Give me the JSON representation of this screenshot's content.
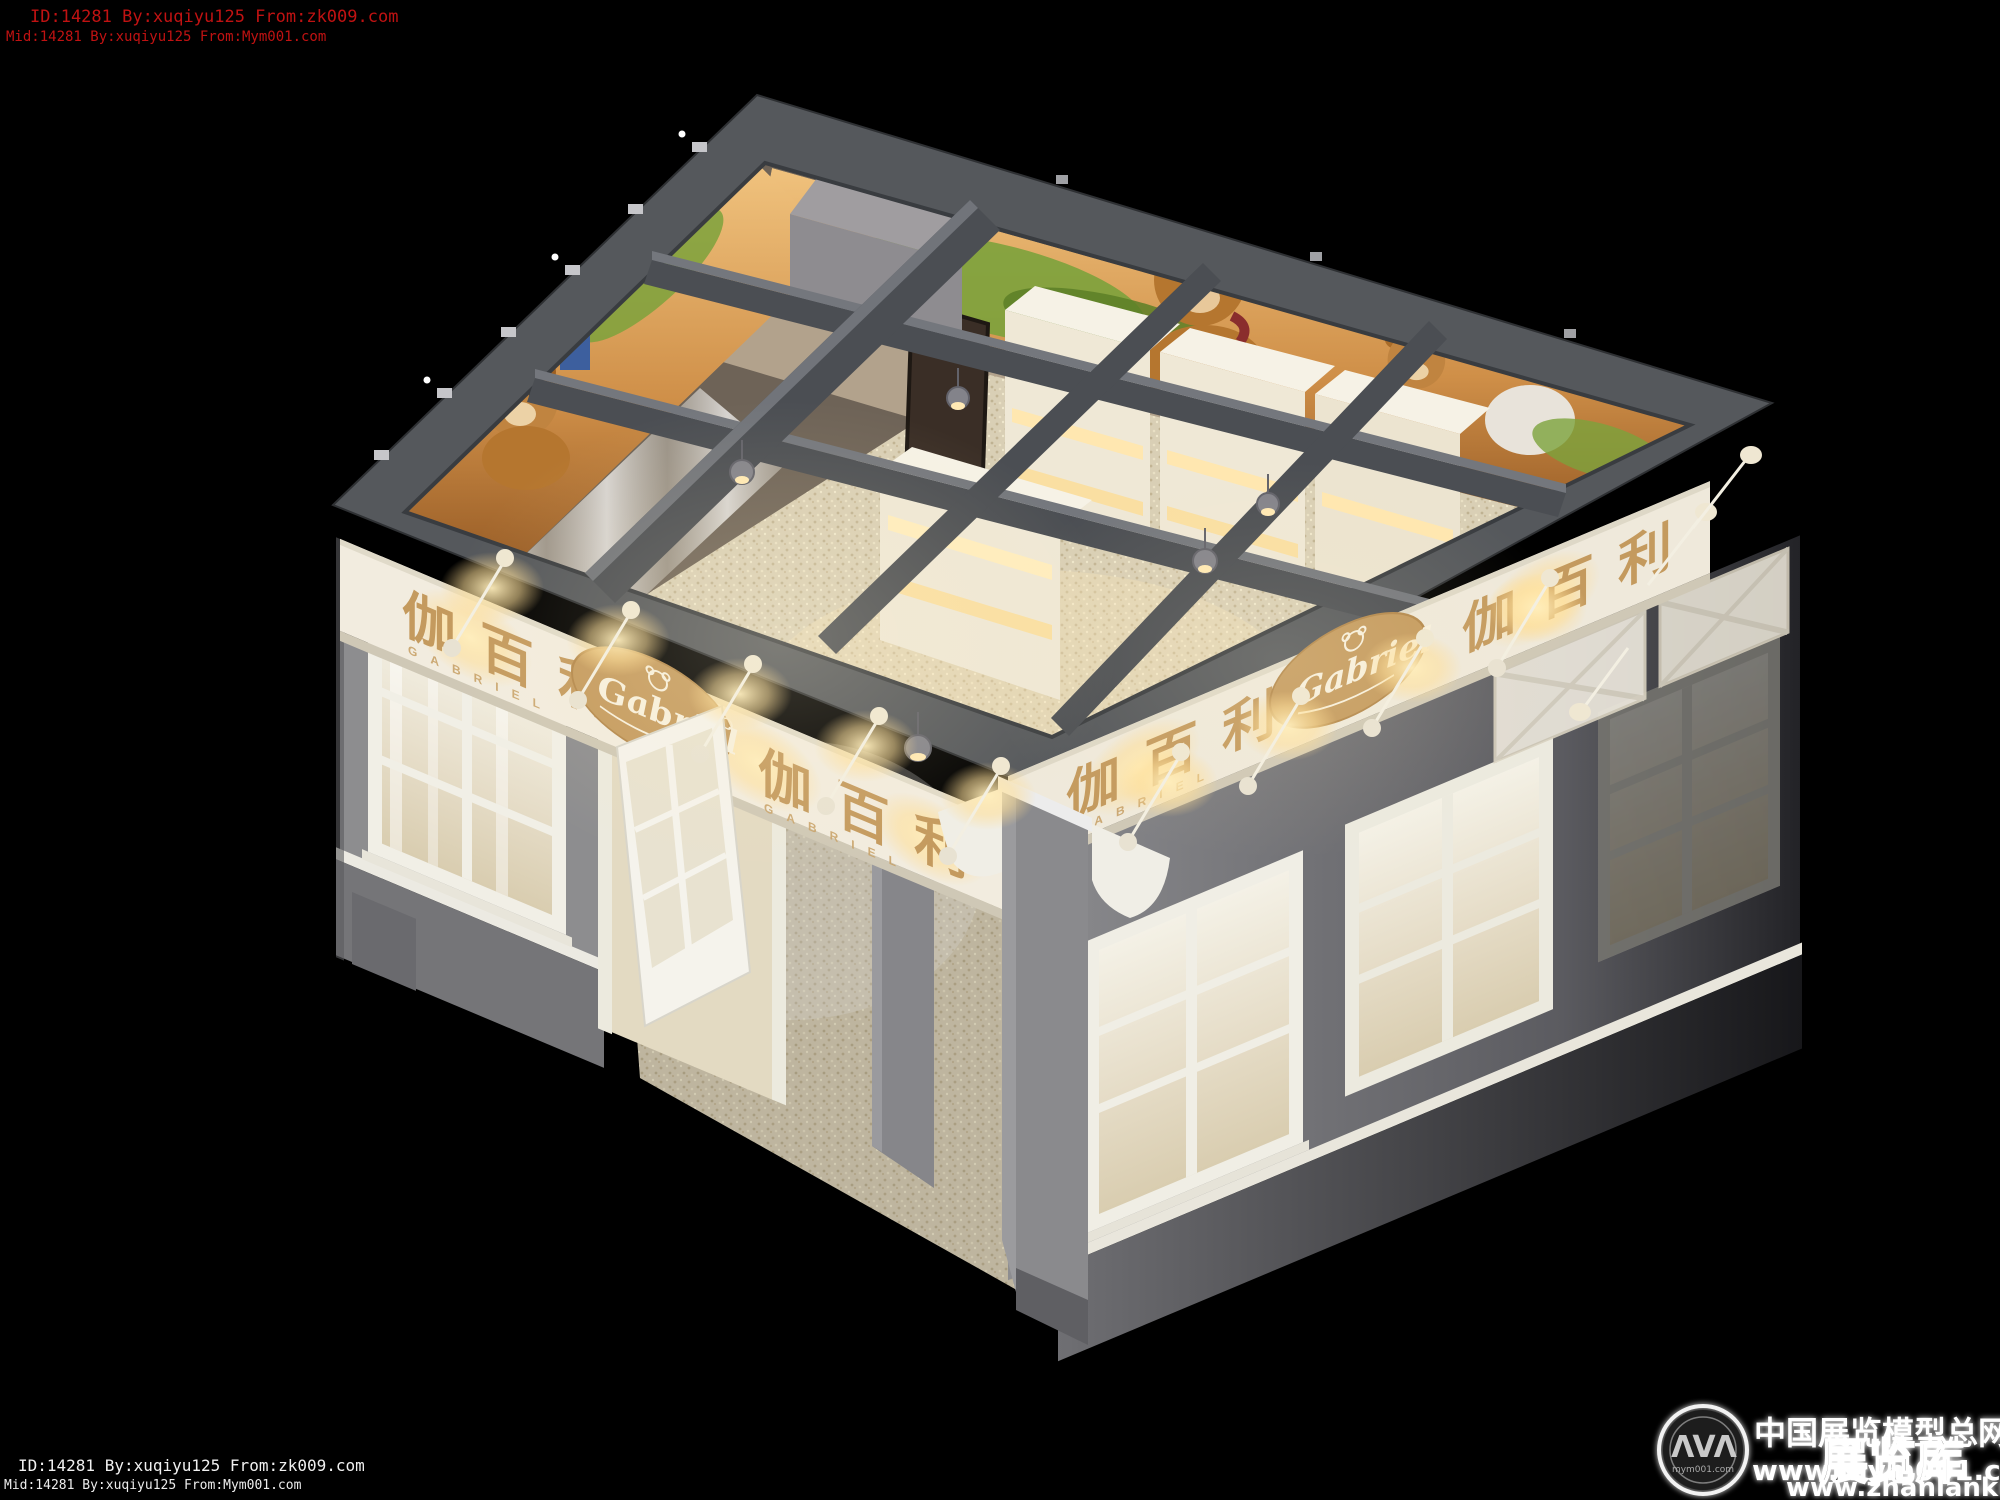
{
  "watermarks": {
    "top_left": {
      "line1": "ID:14281 By:xuqiyu125 From:zk009.com",
      "line2": "Mid:14281 By:xuqiyu125 From:Mym001.com",
      "color": "#c01212"
    },
    "bottom_left": {
      "line1": "ID:14281 By:xuqiyu125 From:zk009.com",
      "line2": "Mid:14281 By:xuqiyu125 From:Mym001.com",
      "color": "#f0f0f0"
    },
    "bottom_right": {
      "site_name_cn": "中国展览模型总网",
      "url_mym": "www.mym001.com",
      "library_cn": "展览库",
      "url_zhanlanku": "www.zhanlanku.com"
    }
  },
  "logo_badge": {
    "glyph": "ΛVΛ",
    "url": "mym001.com"
  },
  "storefront": {
    "brand_cn": "伽百利",
    "brand_en": "GABRIEL",
    "brand_script": "Gabriel"
  },
  "colors": {
    "background": "#000000",
    "roof_band": "#55585c",
    "beam": "#4b4e53",
    "wall_gray": "#8d8d90",
    "fascia_white": "#f2ecdf",
    "brand_gold": "#c49a5e",
    "carpet": "#d9cfb5",
    "warm_glow": "#ffe6ad",
    "shelf_cream": "#f1ead9",
    "banner_amber": "#c98a45",
    "bear_brown": "#b5762f"
  }
}
